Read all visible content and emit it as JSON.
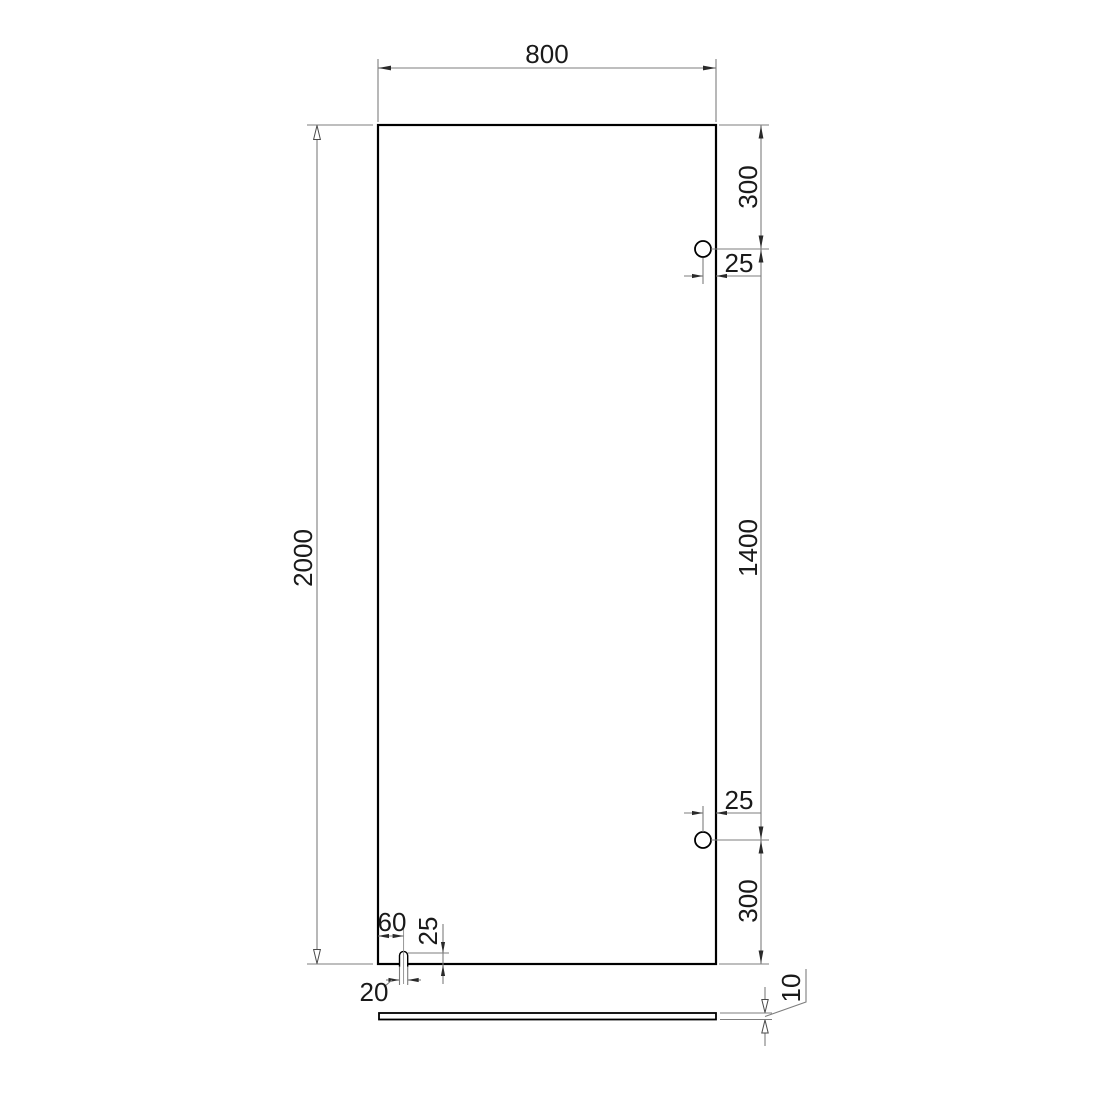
{
  "drawing": {
    "colors": {
      "background": "#ffffff",
      "outline": "#000000",
      "dimension_lines": "#7d7d7d",
      "text": "#1a1a1a"
    },
    "dims": {
      "panel_width": "800",
      "panel_height": "2000",
      "hole_top_offset": "300",
      "hole_top_edge_distance": "25",
      "hole_spacing": "1400",
      "hole_bottom_edge_distance": "25",
      "hole_bottom_offset": "300",
      "slot_center_offset": "60",
      "slot_depth": "25",
      "slot_width": "20",
      "glass_thickness": "10"
    }
  }
}
